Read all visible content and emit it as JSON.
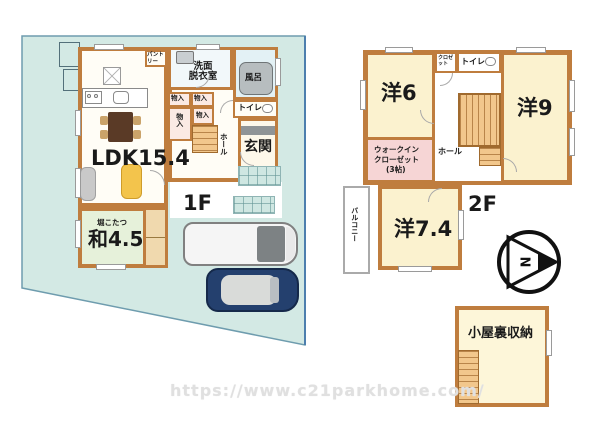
{
  "colors": {
    "site_fill": "#d3e9e4",
    "site_border": "#6e9cae",
    "wall": "#bf7d3e",
    "room_yellow": "#fbf2cf",
    "wic_pink": "#f6d5d5",
    "tatami_green": "#e6f1da",
    "stairs_orange": "#f2c78c",
    "car_navy": "#24406e"
  },
  "floor1": {
    "label": "1F",
    "ldk": "LDK15.4",
    "pantry": "パントリー",
    "washroom": "洗面\n脱衣室",
    "bath": "風呂",
    "toilet": "トイレ",
    "storage": "物入",
    "hall": "ホール",
    "entrance": "玄関",
    "kotatsu": "堀こたつ",
    "washitsu": "和4.5"
  },
  "floor2": {
    "label": "2F",
    "room6": "洋6",
    "room9": "洋9",
    "room74": "洋7.4",
    "toilet": "トイレ",
    "closet": "クロゼット",
    "wic_lines": [
      "ウォークイン",
      "クローゼット",
      "(3帖)"
    ],
    "hall": "ホール",
    "balcony": "バルコニー"
  },
  "attic": {
    "label": "小屋裏収納"
  },
  "compass": {
    "north_label": "N"
  },
  "watermark": "https://www.c21parkhome.com/"
}
